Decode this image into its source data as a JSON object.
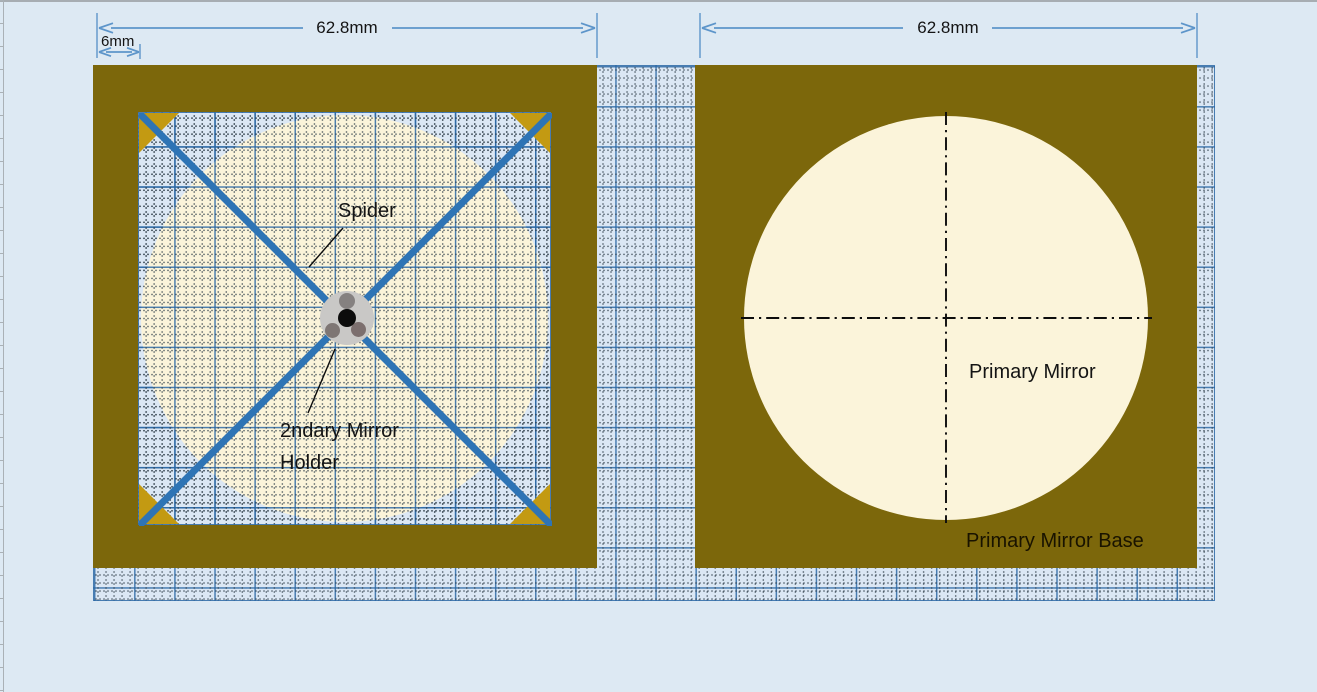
{
  "dimensions": {
    "left_width": "62.8mm",
    "left_frame_thickness": "6mm",
    "right_width": "62.8mm"
  },
  "labels": {
    "spider": "Spider",
    "secondary_holder": "2ndary Mirror Holder",
    "primary_mirror": "Primary Mirror",
    "primary_mirror_base": "Primary Mirror Base"
  },
  "colors": {
    "page-bg": "#dde9f3",
    "graph-bg": "#dbe7f4",
    "frame-olive": "#7c670b",
    "mirror-cream": "#fbf4da",
    "corner-gold": "#c39a12",
    "vane-blue": "#2e74b5",
    "dim-blue": "#5d95ca",
    "holder-gray": "#c9c8c6",
    "holder-dot-gray": "#858180",
    "line-black": "#0c0c0c",
    "text": "#141414"
  }
}
